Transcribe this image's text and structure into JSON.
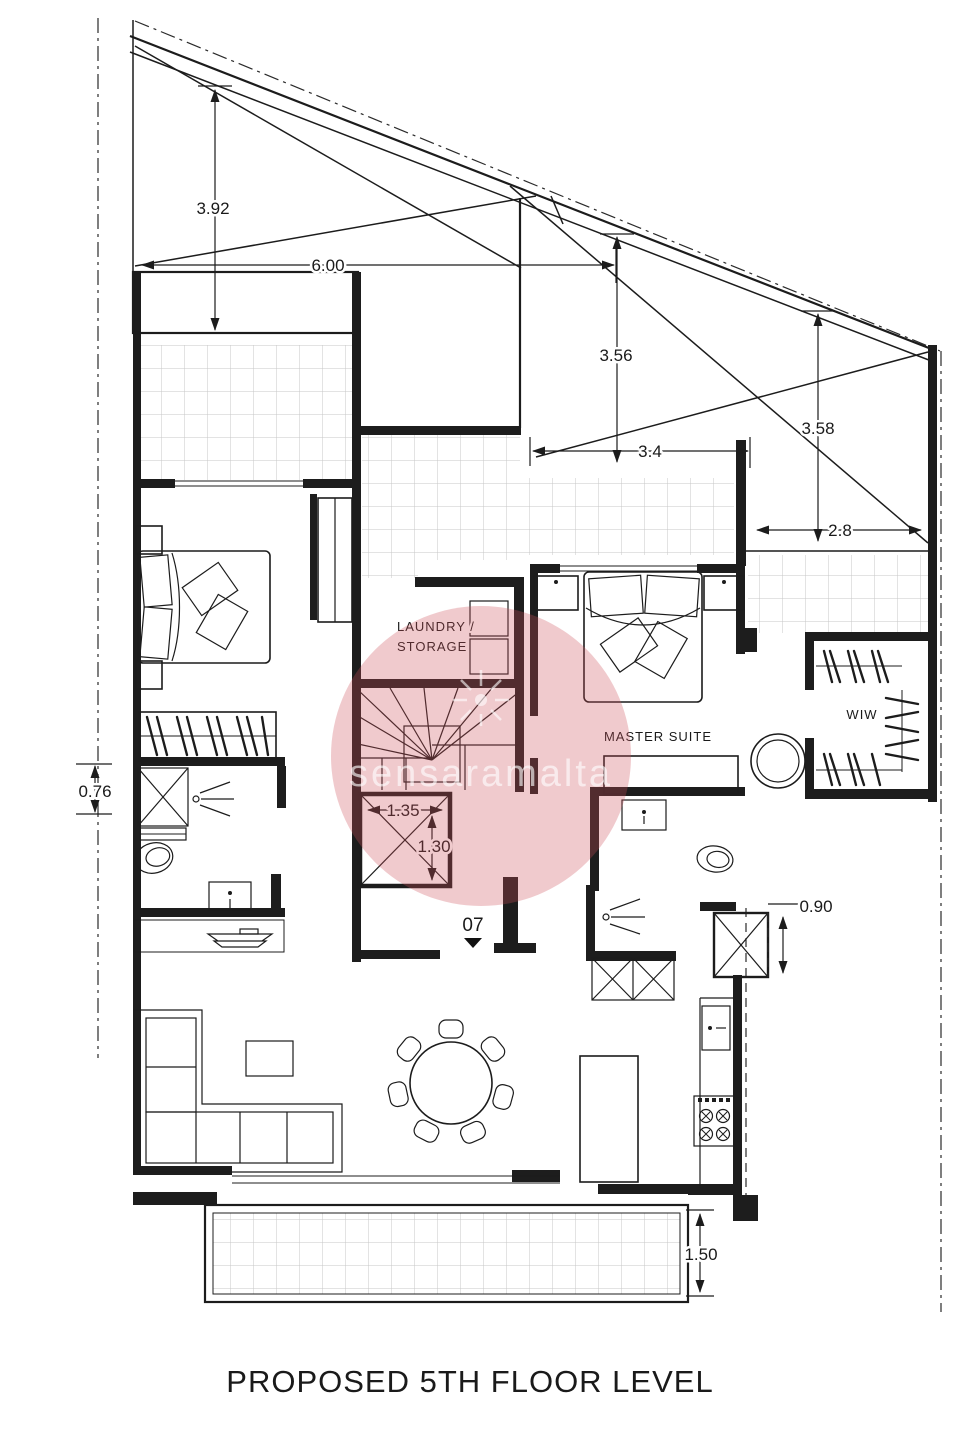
{
  "title": {
    "text": "PROPOSED 5TH FLOOR LEVEL"
  },
  "watermark": {
    "text": "sensaramalta"
  },
  "labels": {
    "laundry_line1": "LAUNDRY /",
    "laundry_line2": "STORAGE",
    "master_suite": "MASTER SUITE",
    "wiw": "WIW",
    "unit_number": "07"
  },
  "dimensions": {
    "roof_height_left": "3.92",
    "roof_span": "6.00",
    "roof_height_mid": "3.56",
    "terrace_mid_width": "3.4",
    "roof_height_right": "3.58",
    "terrace_right_width": "2.8",
    "duct_left": "0.76",
    "lift_width": "1.35",
    "lift_depth": "1.30",
    "duct_right": "0.90",
    "terrace_bottom_depth": "1.50"
  },
  "colors": {
    "line": "#1c1c1c",
    "tile_grid": "#c7c7c7",
    "watermark_pink": "#cd505a"
  }
}
